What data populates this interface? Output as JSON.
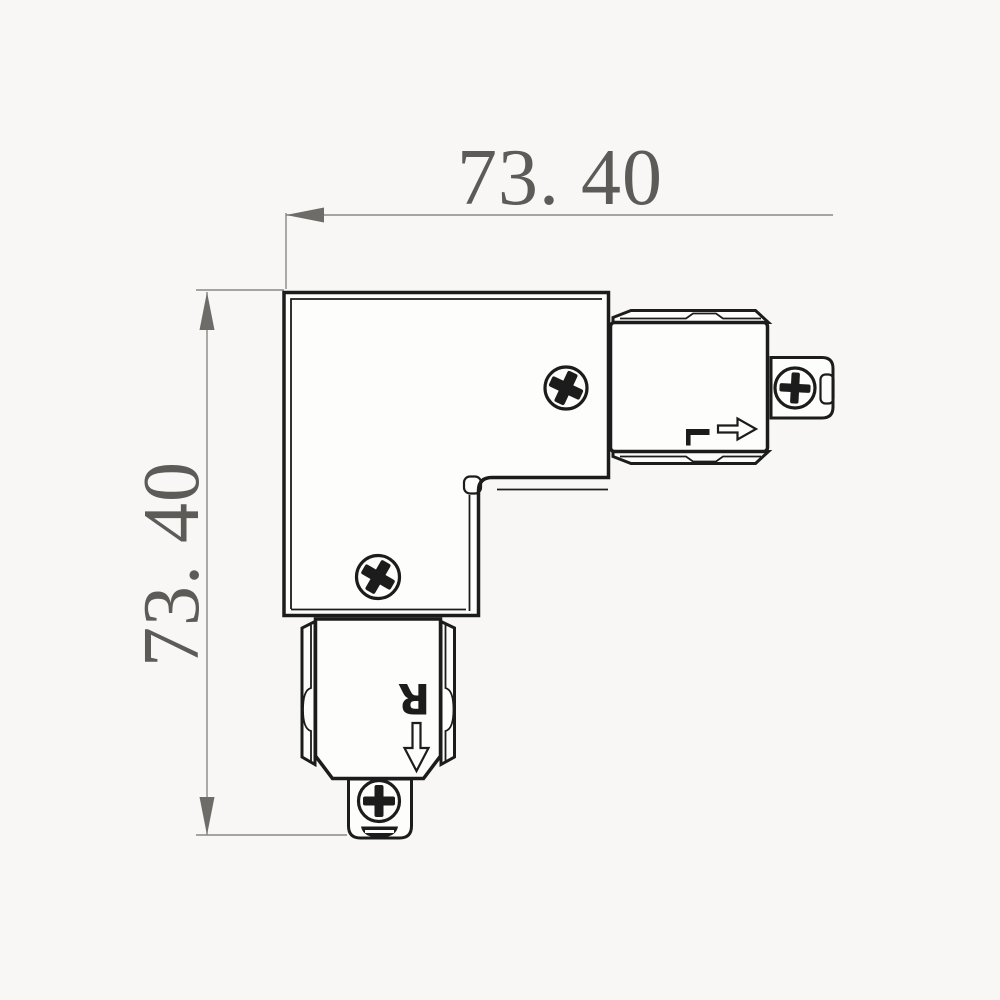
{
  "dimensions": {
    "width_label": "73. 40",
    "height_label": "73. 40"
  },
  "connector_markings": {
    "right_letter": "L",
    "bottom_letter": "R"
  },
  "colors": {
    "background": "#f8f7f5",
    "outline": "#1c1c1c",
    "part_fill": "#fdfdfc",
    "dimension_line": "#8a8783",
    "dimension_arrow": "#6e6c68",
    "dimension_text": "#5d5b57"
  }
}
